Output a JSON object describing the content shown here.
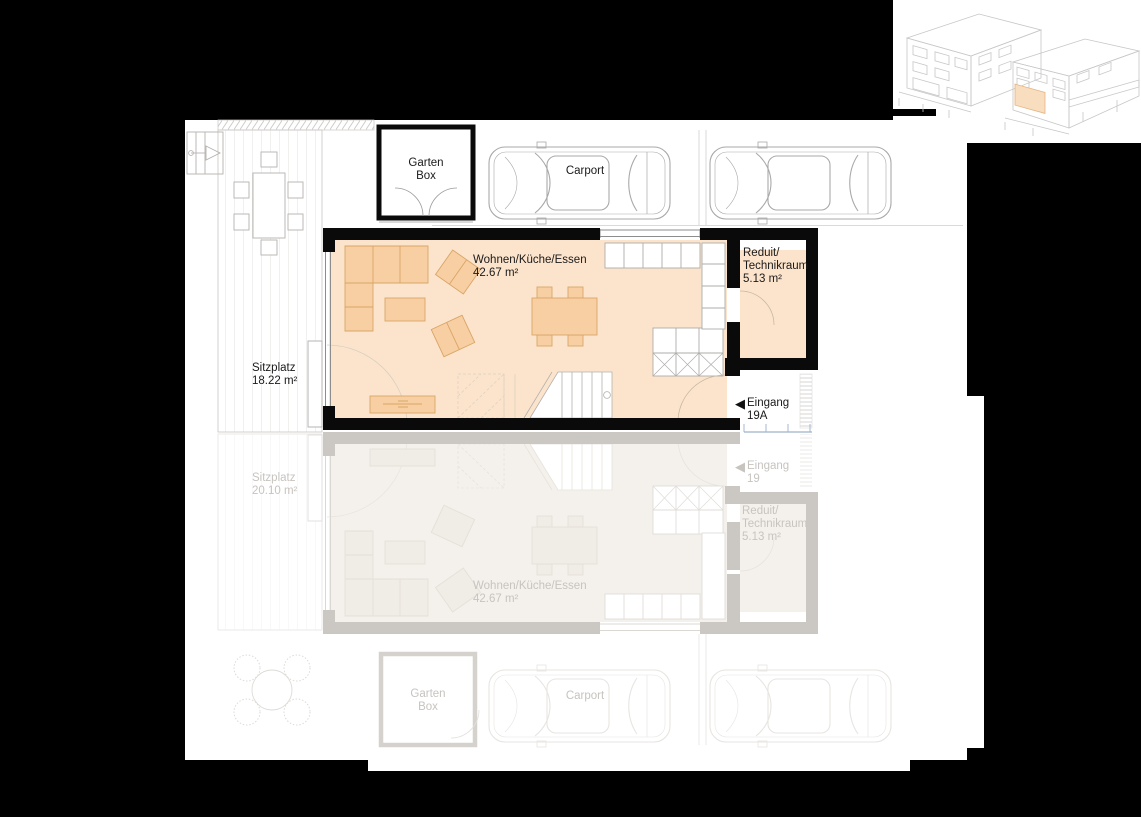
{
  "title": "Grundriss Erdgeschoss",
  "colors": {
    "background": "#000000",
    "paper": "#ffffff",
    "room_fill": "#fce4cc",
    "furniture_fill": "#f7cfa2",
    "wall": "#0a0a0a",
    "neighbor_fill": "#f4f1ec",
    "neighbor_wall": "#cbc8c4",
    "neighbor_text": "#c7c3bf",
    "highlight": "#f8ddbe",
    "entrance_detail_blue": "#9db3cb"
  },
  "icons": {
    "entrance_arrow": "◀"
  },
  "unit_19a": {
    "garten_box": {
      "line1": "Garten",
      "line2": "Box"
    },
    "carport": "Carport",
    "wohnen": {
      "name": "Wohnen/Küche/Essen",
      "area": "42.67 m²"
    },
    "reduit": {
      "line1": "Reduit/",
      "line2": "Technikraum",
      "area": "5.13 m²"
    },
    "sitzplatz": {
      "name": "Sitzplatz",
      "area": "18.22 m²"
    },
    "eingang": {
      "name": "Eingang",
      "number": "19A"
    }
  },
  "unit_19": {
    "garten_box": {
      "line1": "Garten",
      "line2": "Box"
    },
    "carport": "Carport",
    "wohnen": {
      "name": "Wohnen/Küche/Essen",
      "area": "42.67 m²"
    },
    "reduit": {
      "line1": "Reduit/",
      "line2": "Technikraum",
      "area": "5.13 m²"
    },
    "sitzplatz": {
      "name": "Sitzplatz",
      "area": "20.10 m²"
    },
    "eingang": {
      "name": "Eingang",
      "number": "19"
    }
  }
}
